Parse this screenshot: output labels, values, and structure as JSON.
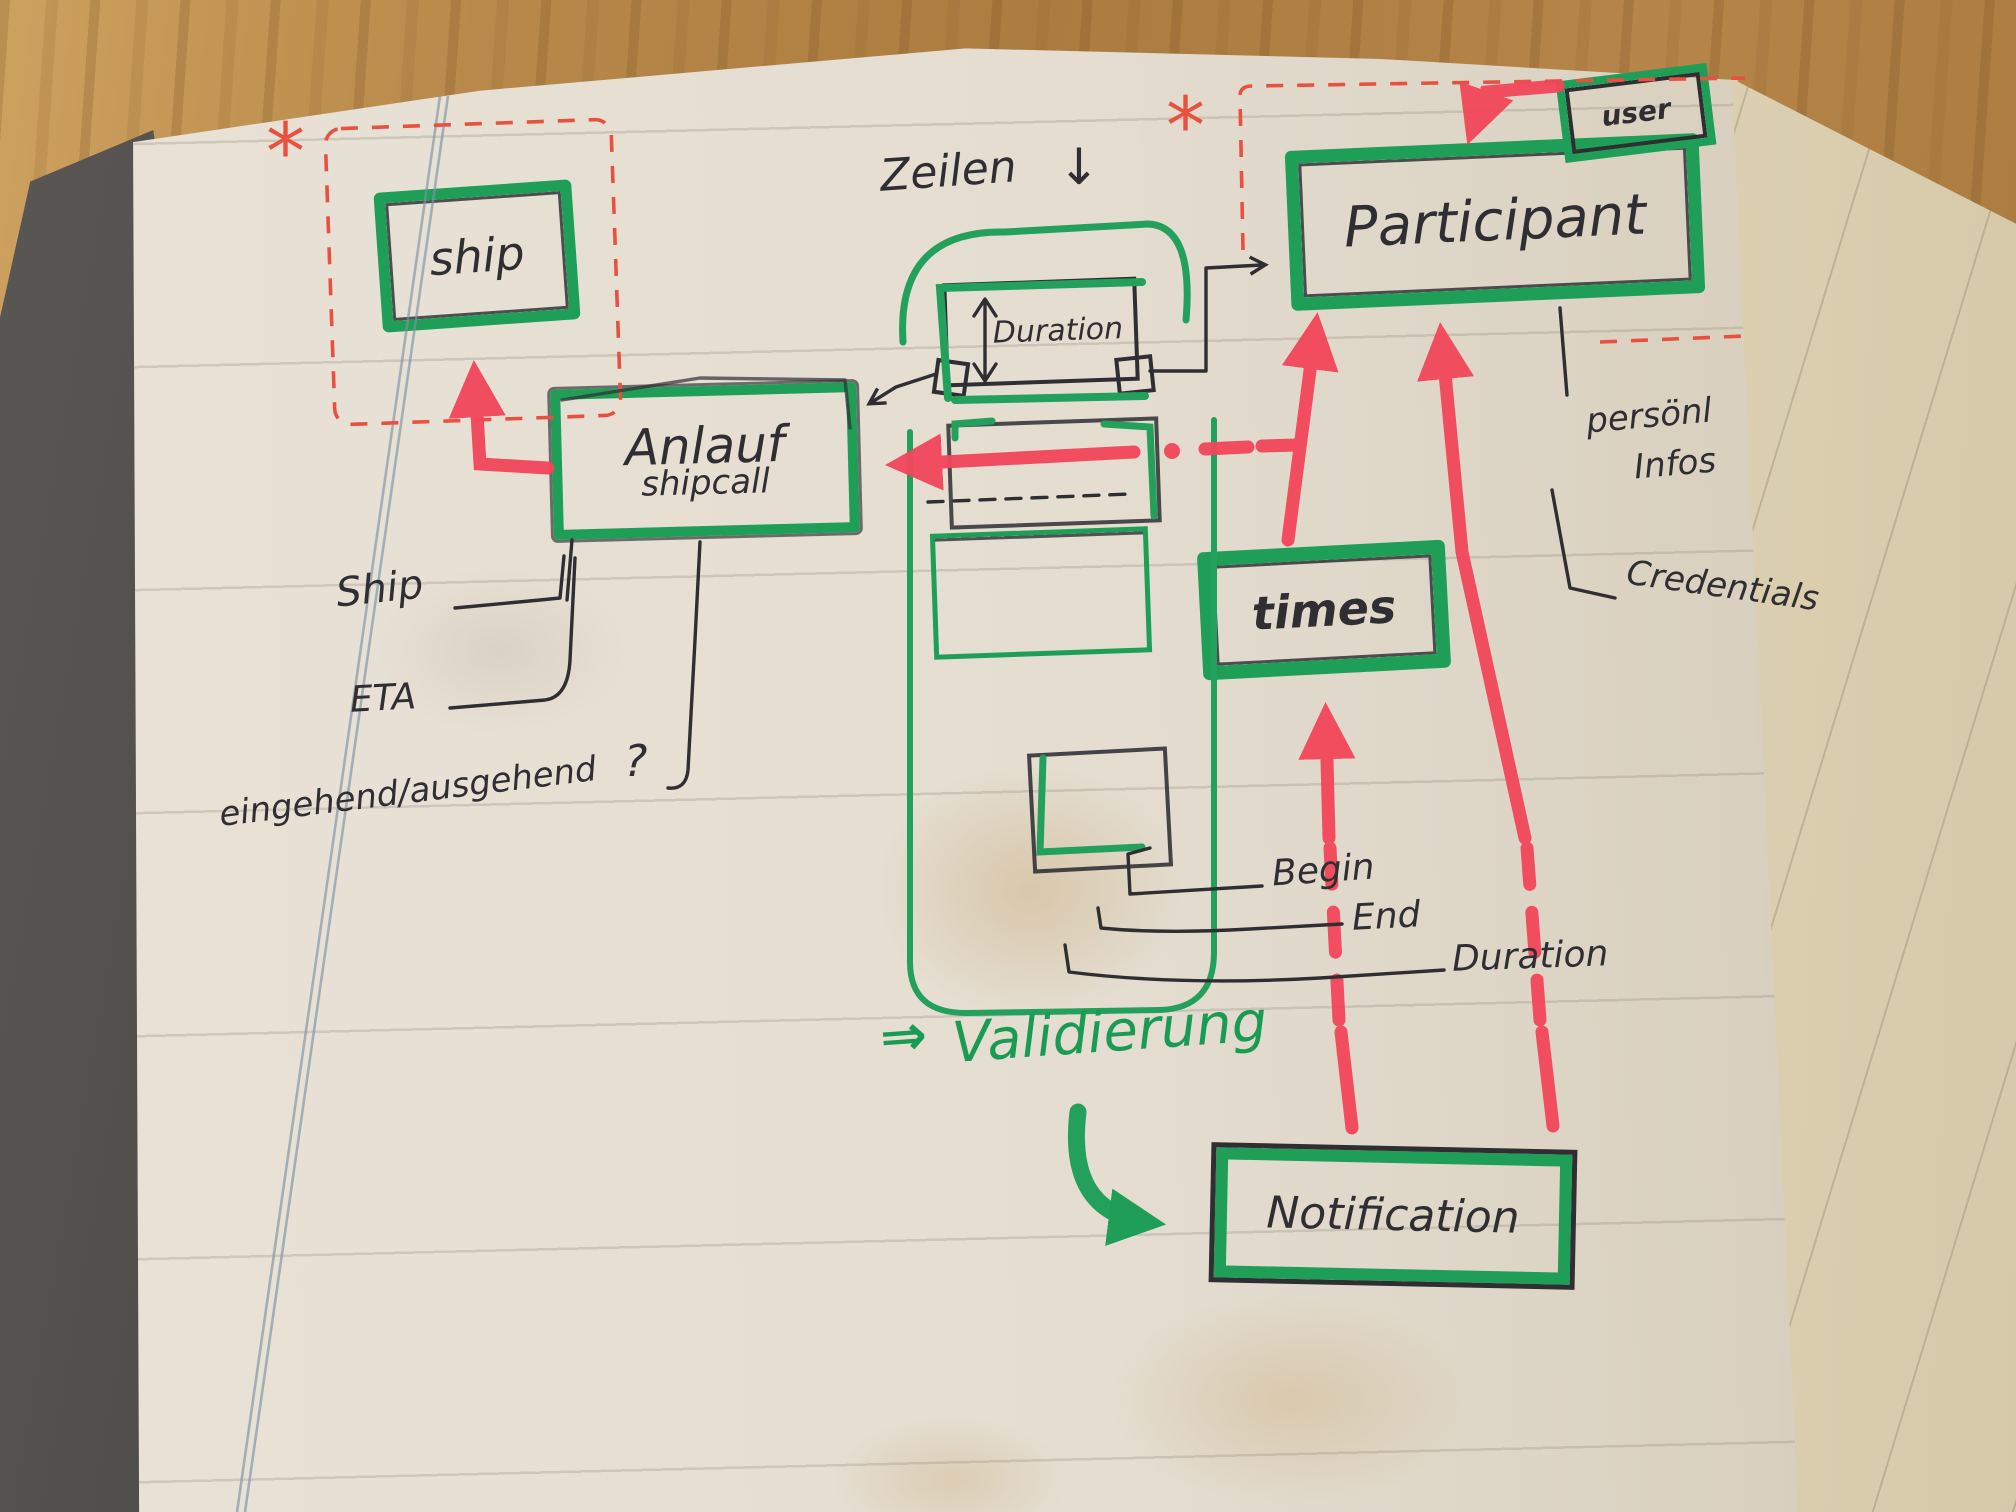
{
  "colors": {
    "marker_green": "#1f9e57",
    "marker_red": "#f2465a",
    "pen_black": "#2e2e33",
    "ink_red_dashed": "#e8503f",
    "paper": "#e6dfd2"
  },
  "boxes": {
    "ship": {
      "label": "ship"
    },
    "anlauf": {
      "label": "Anlauf",
      "sublabel": "shipcall"
    },
    "participant": {
      "label": "Participant"
    },
    "user": {
      "label": "user"
    },
    "duration": {
      "label": "Duration"
    },
    "times": {
      "label": "times"
    },
    "notification": {
      "label": "Notification"
    }
  },
  "annotations": {
    "zeilen": {
      "text": "Zeilen",
      "arrow": "↓"
    },
    "validierung": {
      "text": "Validierung",
      "arrow": "⇒"
    },
    "asterisk": "*"
  },
  "labels": {
    "ship_attr": "Ship",
    "eta": "ETA",
    "in_out": "eingehend/ausgehend",
    "question_mark": "?",
    "begin": "Begin",
    "end": "End",
    "duration": "Duration",
    "personal_infos_line1": "persönl",
    "personal_infos_line2": "Infos",
    "credentials": "Credentials"
  }
}
